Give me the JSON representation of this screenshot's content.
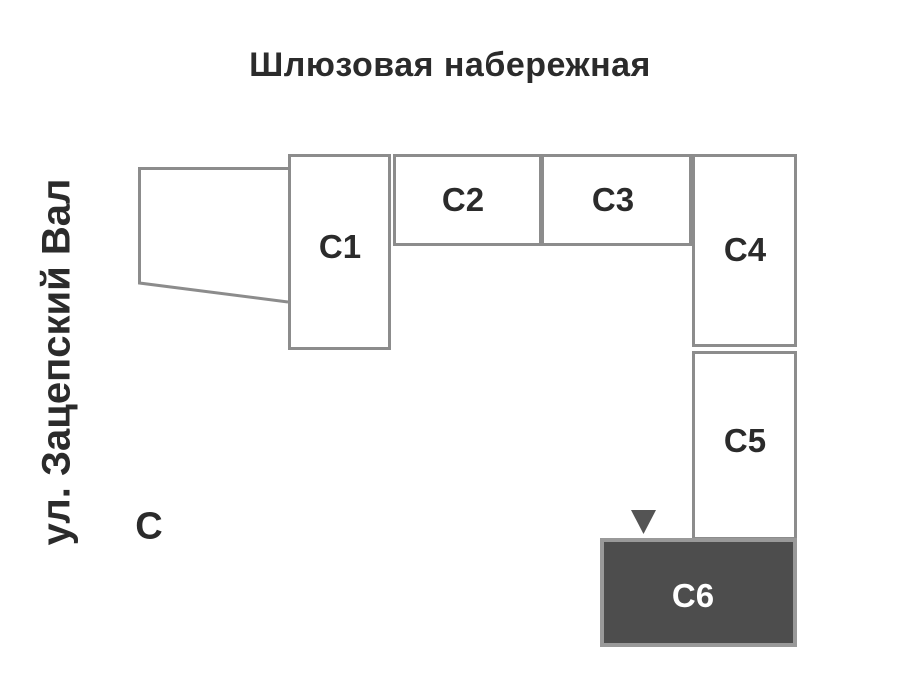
{
  "map": {
    "title_top": "Шлюзовая набережная",
    "street_left": "ул. Зацепский Вал",
    "corner_label": "С",
    "buildings": [
      {
        "id": "C1",
        "label": "С1",
        "highlighted": false
      },
      {
        "id": "C2",
        "label": "С2",
        "highlighted": false
      },
      {
        "id": "C3",
        "label": "С3",
        "highlighted": false
      },
      {
        "id": "C4",
        "label": "С4",
        "highlighted": false
      },
      {
        "id": "C5",
        "label": "С5",
        "highlighted": false
      },
      {
        "id": "C6",
        "label": "С6",
        "highlighted": true
      }
    ],
    "marker": "triangle-pointer-above-C6",
    "colors": {
      "outline": "#8c8c8c",
      "text": "#2b2b2b",
      "highlight_fill": "#4d4d4d",
      "highlight_border": "#999999",
      "highlight_text": "#ffffff",
      "marker": "#545454",
      "background": "#ffffff"
    }
  }
}
